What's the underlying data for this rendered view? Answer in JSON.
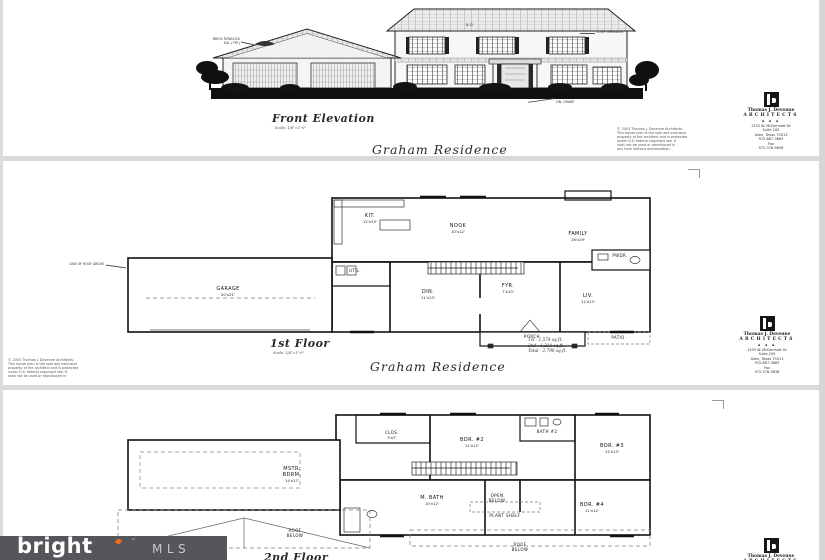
{
  "elevation": {
    "title": "Front Elevation",
    "scale": "Scale: 1/8\"=1'-0\"",
    "residence": "Graham Residence",
    "annotations": {
      "left1": "BRICK ROWLOCK",
      "left2": "SILL (TYP.)",
      "roof": "8:12",
      "right": "COMP. SHINGLES",
      "grade": "FIN. GRADE"
    }
  },
  "first_floor": {
    "title": "1st Floor",
    "scale": "Scale: 1/4\"=1'-0\"",
    "residence": "Graham Residence",
    "areas": {
      "line1": "1st  -  1,574 sq.ft.",
      "line2": "2nd  -  1,224 sq.ft.",
      "line3": "Total - 2,798 sq.ft."
    },
    "annotation_roof": "LINE OF ROOF ABOVE",
    "rooms": {
      "kit": {
        "label": "KIT.",
        "size": "12'x13'"
      },
      "nook": {
        "label": "NOOK",
        "size": "10'x12'"
      },
      "family": {
        "label": "FAMILY",
        "size": "16'x19'"
      },
      "util": {
        "label": "UTIL."
      },
      "din": {
        "label": "DIN.",
        "size": "11'x13'"
      },
      "fyr": {
        "label": "FYR.",
        "size": "7'x10'"
      },
      "liv": {
        "label": "LIV.",
        "size": "11'x13'"
      },
      "pwdr": {
        "label": "PWDR."
      },
      "garage": {
        "label": "GARAGE",
        "size": "20'x21'"
      },
      "porch": {
        "label": "PORCH"
      },
      "patio": {
        "label": "PATIO"
      }
    }
  },
  "second_floor": {
    "title": "2nd Floor",
    "rooms": {
      "clos": {
        "label": "CLOS.",
        "size": "5'x7'"
      },
      "bdr2": {
        "label": "BDR. #2",
        "size": "11'x12'"
      },
      "bath2": {
        "label": "BATH #2"
      },
      "bdr3": {
        "label": "BDR. #3",
        "size": "12'x13'"
      },
      "mstr": {
        "label": "MSTR.",
        "label2": "BDRM.",
        "size": "14'x17'"
      },
      "mbath": {
        "label": "M. BATH",
        "size": "10'x12'"
      },
      "open": {
        "label": "OPEN",
        "label2": "BELOW"
      },
      "plant": {
        "label": "PLANT SHELF"
      },
      "bdr4": {
        "label": "BDR. #4",
        "size": "11'x12'"
      },
      "roof1": {
        "label": "ROOF",
        "label2": "BELOW"
      },
      "roof2": {
        "label": "ROOF",
        "label2": "BELOW"
      }
    }
  },
  "stamp": {
    "name": "Thomas J. Devenne",
    "firm": "ARCHITECTS",
    "dots": "▪ ▪ ▪",
    "address1": "1333 W. McDermott Dr",
    "address2": "Suite 200",
    "address3": "Allen, Texas 75013",
    "phone": "972-867-3663",
    "fax_label": "Fax",
    "fax": "972-378-9636"
  },
  "copyright": {
    "lines": [
      "© 2003 Thomas J. Devenne Architects.",
      "This house plan is the sole and exclusive",
      "property of the architect and is protected",
      "under U.S. federal copyright law.  It",
      "shall not be used or reproduced in",
      "any form without authorization."
    ]
  },
  "watermark": {
    "brand": "bright",
    "tm": "™",
    "suffix": "MLS"
  },
  "colors": {
    "bar": "#55565a",
    "accent": "#f26a22",
    "ink": "#1a1a1a",
    "paper": "#ffffff",
    "separator": "#d9d9d9"
  }
}
